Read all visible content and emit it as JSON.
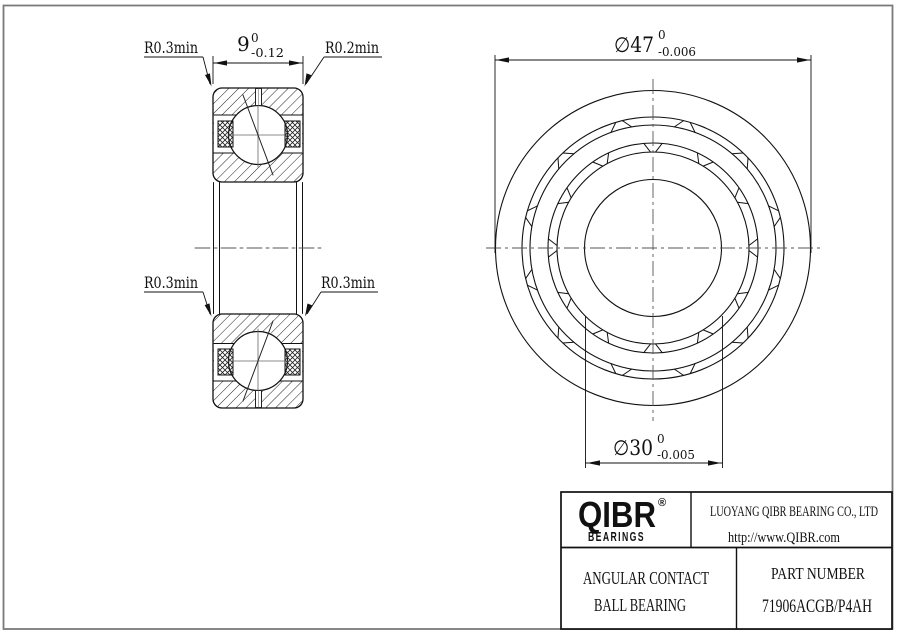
{
  "drawing": {
    "section": {
      "r_top_left": "R0.3min",
      "r_top_right": "R0.2min",
      "r_mid_left": "R0.3min",
      "r_mid_right": "R0.3min",
      "width": {
        "nominal": "9",
        "upper": "0",
        "lower": "-0.12"
      }
    },
    "front": {
      "od": {
        "nominal": "∅47",
        "upper": "0",
        "lower": "-0.006"
      },
      "bore": {
        "nominal": "∅30",
        "upper": "0",
        "lower": "-0.005"
      }
    }
  },
  "title_block": {
    "brand": "QIBR",
    "brand_reg": "®",
    "brand_sub": "BEARINGS",
    "company": "LUOYANG QIBR BEARING CO., LTD",
    "website": "http://www.QIBR.com",
    "product_line1": "ANGULAR CONTACT",
    "product_line2": "BALL BEARING",
    "part_label": "PART NUMBER",
    "part_number": "71906ACGB/P4AH"
  }
}
